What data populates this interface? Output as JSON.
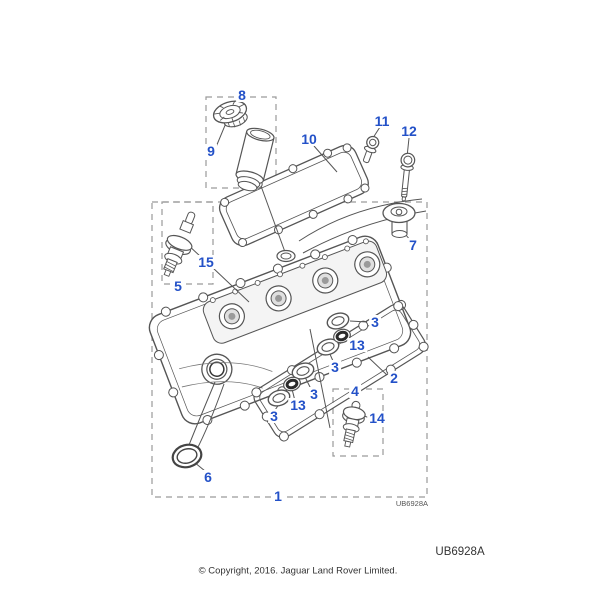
{
  "figure": {
    "callouts": [
      {
        "part": "1",
        "label": "1"
      },
      {
        "part": "2",
        "label": "2"
      },
      {
        "part": "3",
        "label": "3"
      },
      {
        "part": "3",
        "label": "3"
      },
      {
        "part": "3",
        "label": "3"
      },
      {
        "part": "3",
        "label": "3"
      },
      {
        "part": "4",
        "label": "4"
      },
      {
        "part": "5",
        "label": "5"
      },
      {
        "part": "6",
        "label": "6"
      },
      {
        "part": "7",
        "label": "7"
      },
      {
        "part": "8",
        "label": "8"
      },
      {
        "part": "9",
        "label": "9"
      },
      {
        "part": "10",
        "label": "10"
      },
      {
        "part": "11",
        "label": "11"
      },
      {
        "part": "12",
        "label": "12"
      },
      {
        "part": "13",
        "label": "13"
      },
      {
        "part": "13",
        "label": "13"
      },
      {
        "part": "14",
        "label": "14"
      },
      {
        "part": "15",
        "label": "15"
      }
    ],
    "drawing_code_small": "UB6928A",
    "drawing_code": "UB6928A",
    "copyright": "© Copyright, 2016. Jaguar Land Rover Limited.",
    "colors": {
      "callout_blue": "#2351C8",
      "line_gray": "#555555",
      "dash_gray": "#9A9A9A"
    }
  }
}
